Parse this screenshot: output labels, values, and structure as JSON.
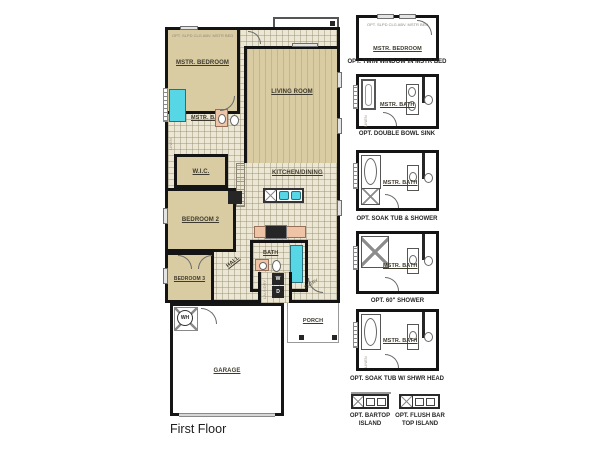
{
  "page": {
    "title": "First Floor"
  },
  "colors": {
    "wall": "#141414",
    "room_fill": "#d9cca3",
    "tile_fill": "#ece7d4",
    "fixture_cyan": "#57d7e6",
    "counter_peach": "#efc4a6",
    "background": "#ffffff"
  },
  "plan": {
    "rooms": {
      "covered_patio": "COVERED PATIO",
      "mstr_bedroom": "MSTR. BEDROOM",
      "living_room": "LIVING ROOM",
      "mstr_bath": "MSTR. BATH",
      "wic": "W.I.C.",
      "bedroom_2": "BEDROOM 2",
      "kitchen_dining": "KITCHEN/DINING",
      "hall": "HALL",
      "bath": "BATH",
      "laundry": "LAUNDRY",
      "entry": "ENTRY",
      "bedroom_3": "BEDROOM 3",
      "garage": "GARAGE",
      "porch": "PORCH",
      "linen": "LINEN"
    },
    "appliances": {
      "water_heater": "WH",
      "washer": "W",
      "dryer": "D"
    },
    "notes": {
      "mbr_ceiling": "OPT. SLPD CLG ABV. MSTR BED"
    }
  },
  "options": [
    {
      "caption": "OPT. TWIN WINDOW IN MSTR BED",
      "room_label": "MSTR. BEDROOM",
      "note": "OPT. SLPD CLG ABV. MSTR BED"
    },
    {
      "caption": "OPT. DOUBLE BOWL SINK",
      "room_label": "MSTR. BATH",
      "closet_label": "LINEN"
    },
    {
      "caption": "OPT. SOAK TUB & SHOWER",
      "room_label": "MSTR. BATH"
    },
    {
      "caption": "OPT. 60\" SHOWER",
      "room_label": "MSTR. BATH"
    },
    {
      "caption": "OPT. SOAK TUB W/ SHWR HEAD",
      "room_label": "MSTR. BATH",
      "closet_label": "LINEN"
    },
    {
      "caption": "OPT. BARTOP ISLAND"
    },
    {
      "caption": "OPT. FLUSH BAR TOP ISLAND"
    }
  ]
}
